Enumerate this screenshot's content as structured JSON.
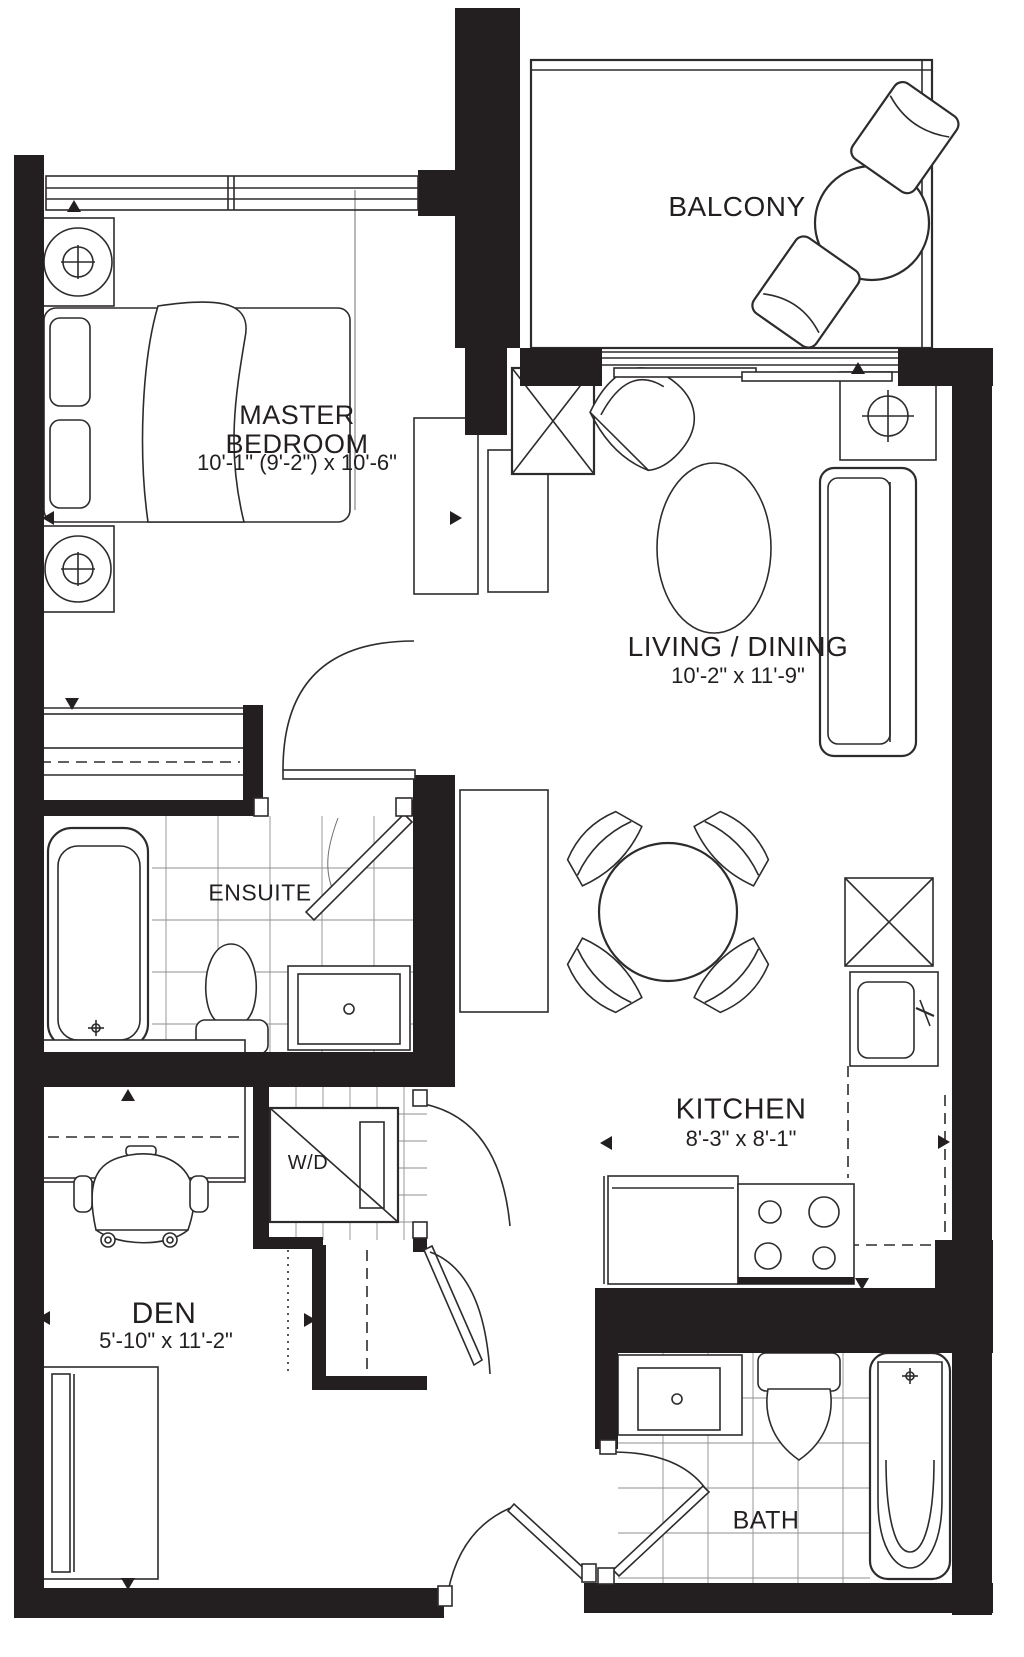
{
  "plan": {
    "title": "Condo unit floor plan",
    "rooms": {
      "balcony": {
        "name": "BALCONY"
      },
      "master_bedroom": {
        "name": "MASTER BEDROOM",
        "dimensions": "10'-1\" (9'-2\") x 10'-6\""
      },
      "living_dining": {
        "name": "LIVING / DINING",
        "dimensions": "10'-2\" x 11'-9\""
      },
      "ensuite": {
        "name": "ENSUITE"
      },
      "kitchen": {
        "name": "KITCHEN",
        "dimensions": "8'-3\" x 8'-1\""
      },
      "laundry": {
        "name": "W/D"
      },
      "den": {
        "name": "DEN",
        "dimensions": "5'-10\" x 11'-2\""
      },
      "bath": {
        "name": "BATH"
      }
    },
    "colors": {
      "wall": "#231f20",
      "line": "#2e2b2c",
      "tile": "#8f8f8f",
      "background": "#ffffff"
    }
  }
}
